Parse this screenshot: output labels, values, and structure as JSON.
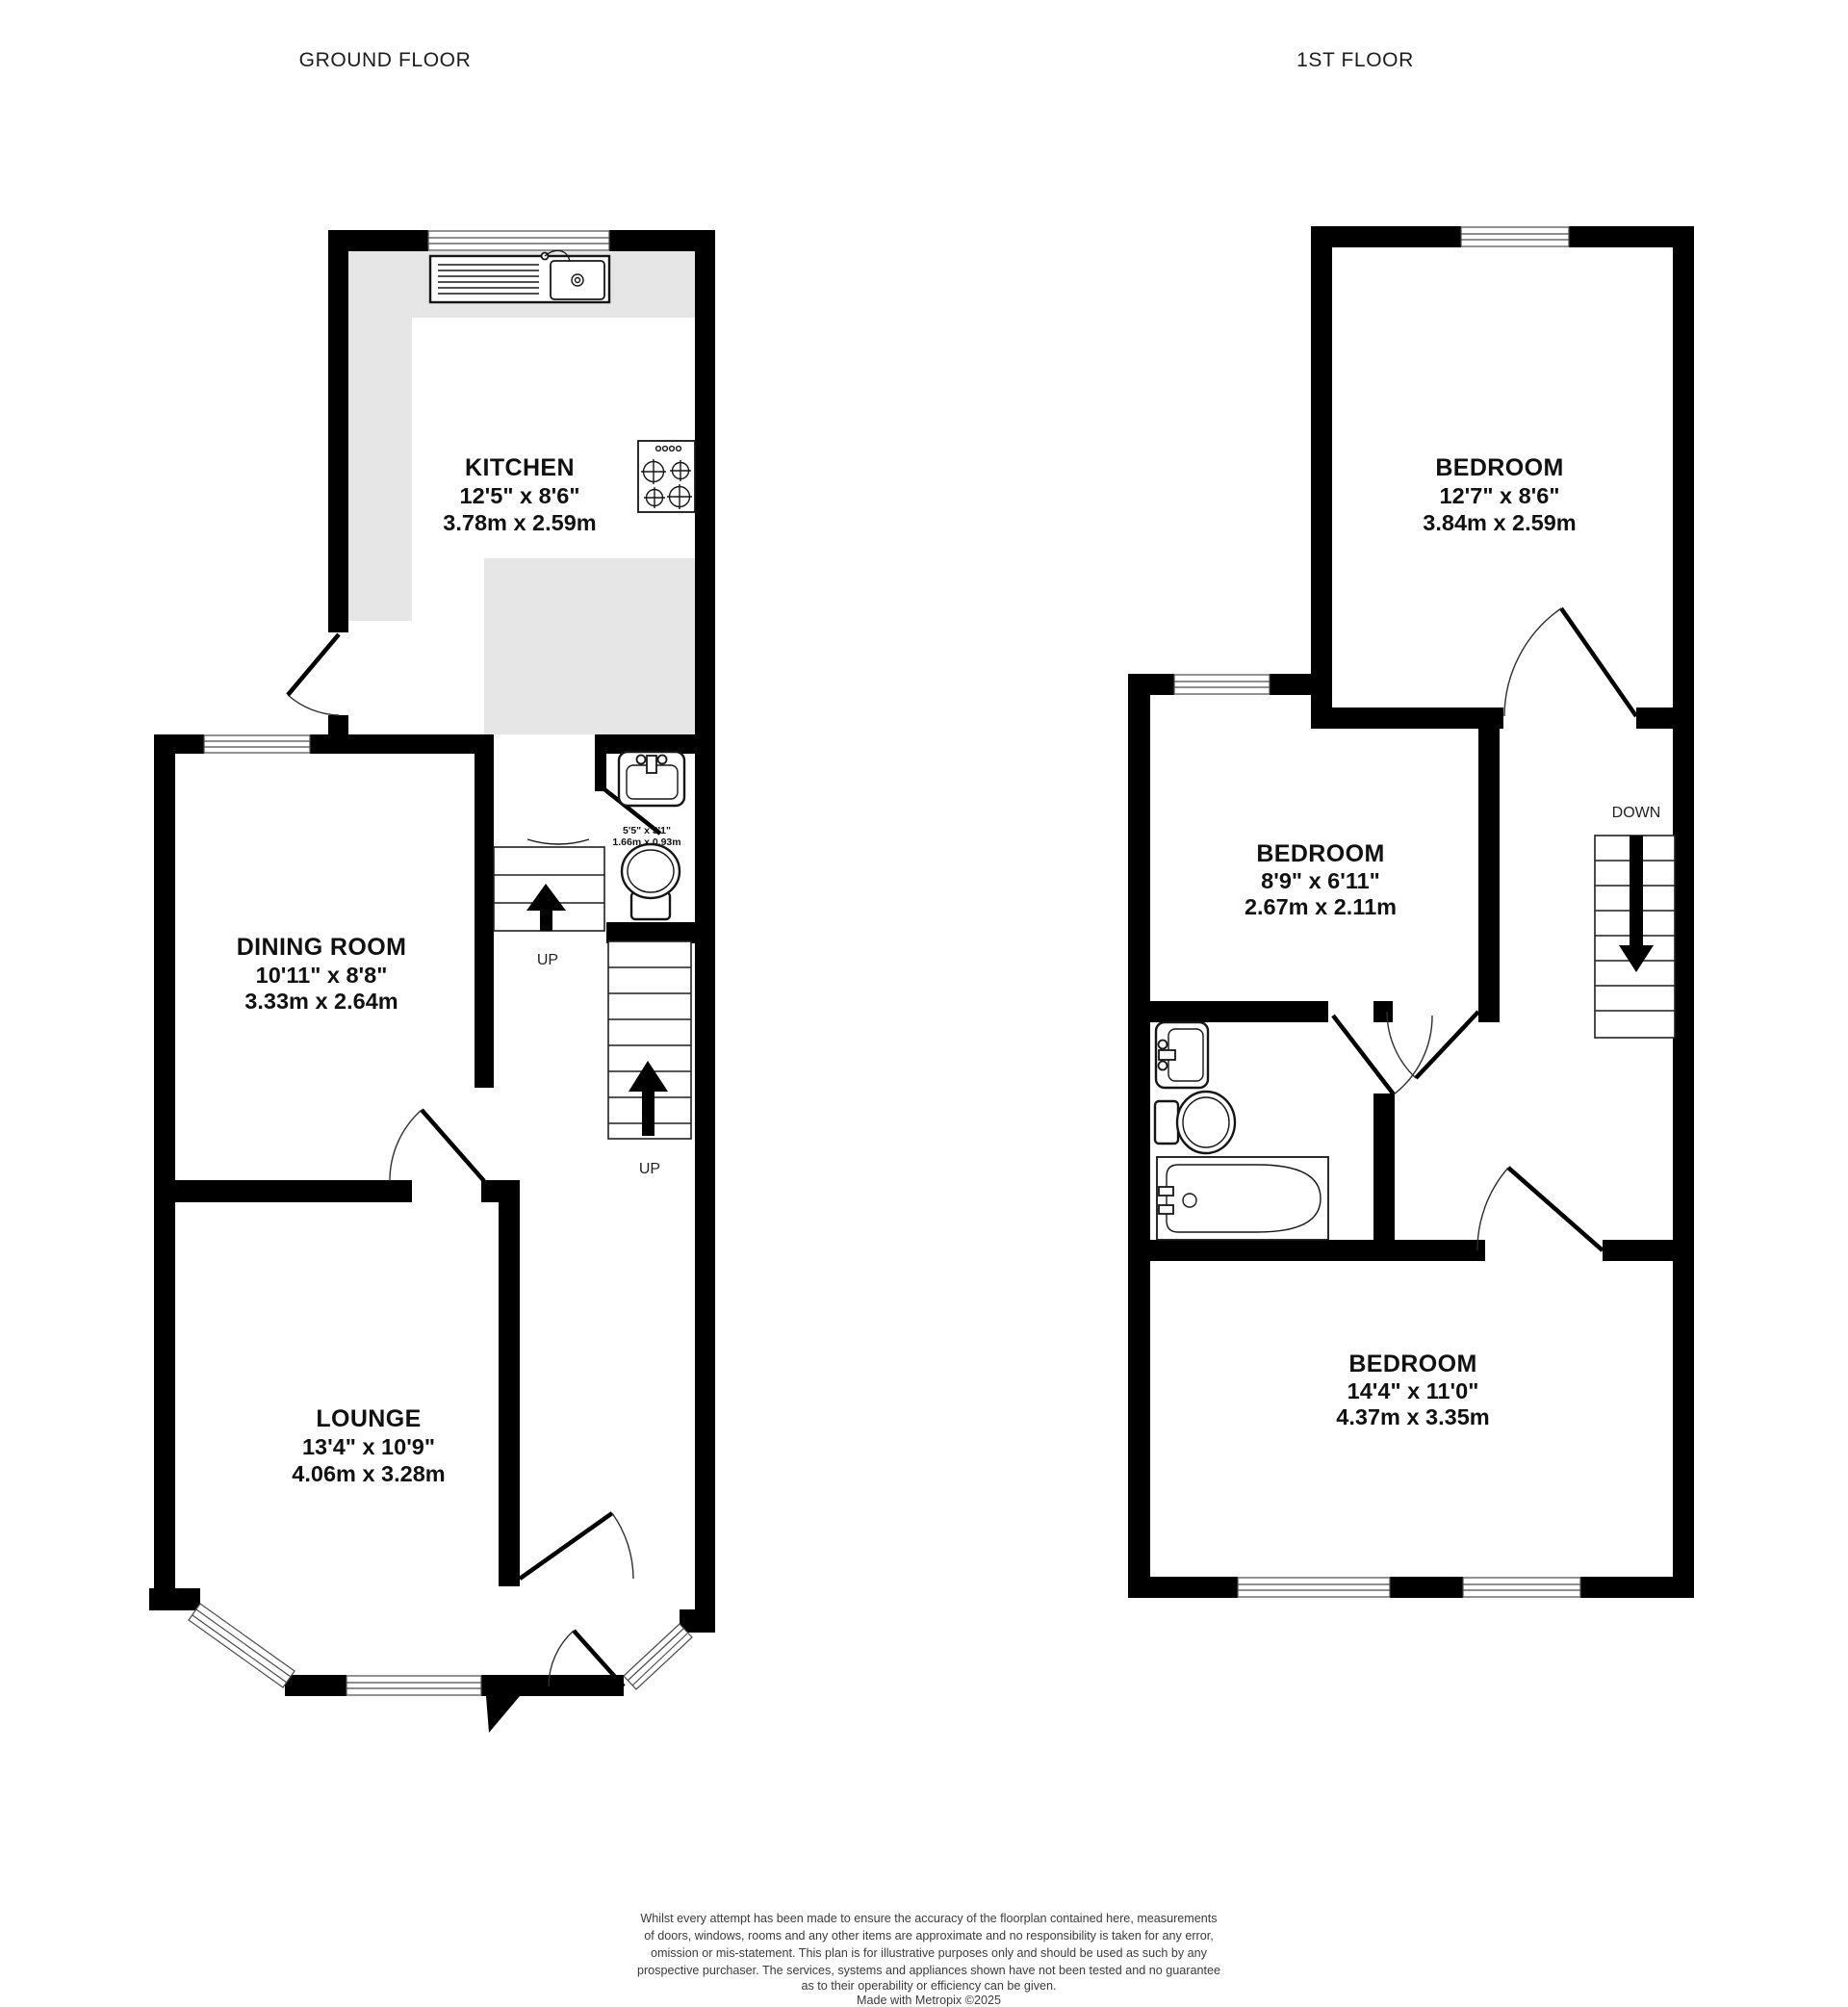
{
  "colors": {
    "wall": "#000000",
    "kitchen_counter": "#e6e6e6",
    "background": "#ffffff",
    "text": "#111111"
  },
  "ground_floor": {
    "title": "GROUND FLOOR",
    "rooms": {
      "kitchen": {
        "name": "KITCHEN",
        "size_imperial": "12'5\"  x 8'6\"",
        "size_metric": "3.78m  x 2.59m"
      },
      "dining": {
        "name": "DINING ROOM",
        "size_imperial": "10'11\"  x 8'8\"",
        "size_metric": "3.33m  x 2.64m"
      },
      "lounge": {
        "name": "LOUNGE",
        "size_imperial": "13'4\"  x 10'9\"",
        "size_metric": "4.06m  x 3.28m"
      },
      "wc": {
        "size_imperial": "5'5\"  x 3'1\"",
        "size_metric": "1.66m  x 0.93m"
      }
    },
    "stair_labels": {
      "up_lower": "UP",
      "up_upper": "UP"
    }
  },
  "first_floor": {
    "title": "1ST FLOOR",
    "rooms": {
      "bedroom1": {
        "name": "BEDROOM",
        "size_imperial": "12'7\"  x 8'6\"",
        "size_metric": "3.84m  x 2.59m"
      },
      "bedroom2": {
        "name": "BEDROOM",
        "size_imperial": "8'9\"  x 6'11\"",
        "size_metric": "2.67m  x 2.11m"
      },
      "bedroom3": {
        "name": "BEDROOM",
        "size_imperial": "14'4\"  x 11'0\"",
        "size_metric": "4.37m  x 3.35m"
      }
    },
    "stair_labels": {
      "down": "DOWN"
    }
  },
  "footer": {
    "disclaimer_lines": [
      "Whilst every attempt has been made to ensure the accuracy of the floorplan contained here, measurements",
      "of doors, windows, rooms and any other items are approximate and no responsibility is taken for any error,",
      "omission or mis-statement. This plan is for illustrative purposes only and should be used as such by any",
      "prospective purchaser. The services, systems and appliances shown have not been tested and no guarantee",
      "as to their operability or efficiency can be given."
    ],
    "credit": "Made with Metropix ©2025"
  }
}
